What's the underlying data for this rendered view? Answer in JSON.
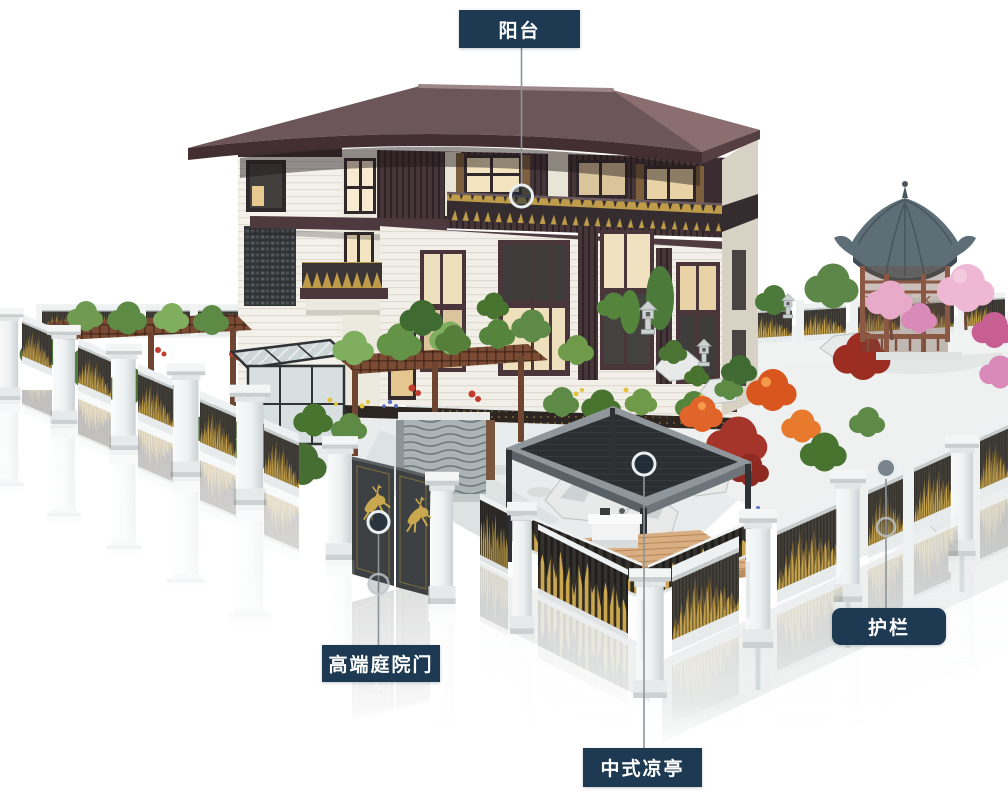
{
  "callouts": [
    {
      "id": "balcony",
      "label": "阳台"
    },
    {
      "id": "courtyard-gate",
      "label": "高端庭院门"
    },
    {
      "id": "pavilion",
      "label": "中式凉亭"
    },
    {
      "id": "guardrail",
      "label": "护栏"
    }
  ],
  "colors": {
    "callout_bg": "#1d3a52",
    "callout_text": "#ffffff",
    "connector_line": "#8d959b",
    "marker_ring": "#e9eef1",
    "roof": "#6d5659",
    "roof_light": "#8b6e70",
    "wall": "#f1efe7",
    "wood_dark": "#46363a",
    "gold": "#c5a24c",
    "fence_panel": "#45413b",
    "fence_pillar": "#eef1f2",
    "gate_panel": "#3d4042",
    "gazebo_roof": "#5d6e77",
    "pavilion_canopy": "#2b2f31",
    "deck": "#d9ae82"
  }
}
